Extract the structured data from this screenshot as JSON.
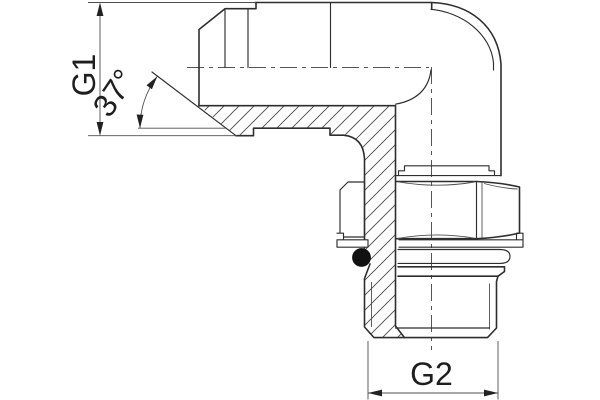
{
  "drawing": {
    "type": "technical-section-drawing",
    "subject": "90-degree adjustable elbow adapter, half-section view",
    "colors": {
      "background": "#ffffff",
      "line": "#2e2e2e",
      "thin_line": "#4f4f4f",
      "hatch": "#4a4a4a",
      "o_ring_fill": "#111111",
      "text": "#1e1e1e"
    },
    "dimensions": {
      "g1": {
        "label": "G1"
      },
      "g2": {
        "label": "G2"
      },
      "flare_angle": {
        "label": "37°"
      }
    }
  }
}
